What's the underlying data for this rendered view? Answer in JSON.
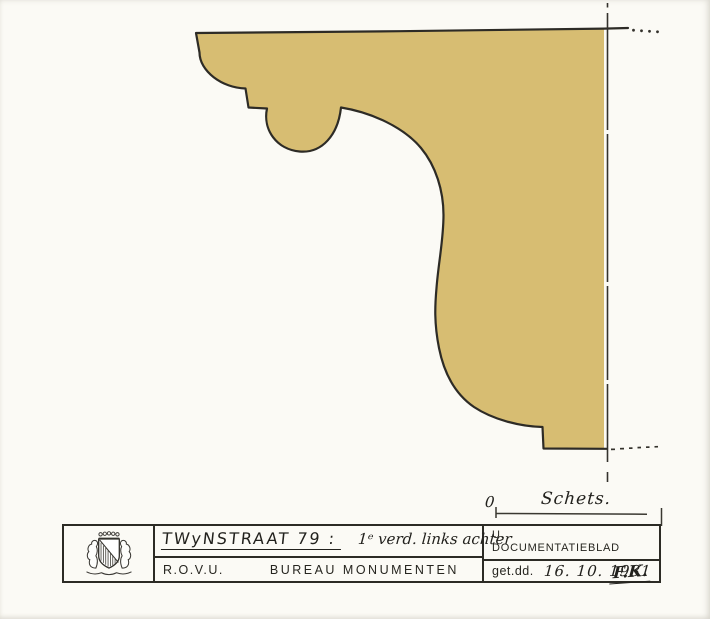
{
  "colors": {
    "shape_fill": "#d7bd72",
    "ink": "#2d2b26",
    "paper": "#fbfaf5"
  },
  "drawing": {
    "scale_zero": "0",
    "scale_label": "Schets."
  },
  "title_block": {
    "street_title": "TWyNSTRAAT 79 :",
    "annotation": "1ᵉ verd. links achter",
    "org_abbr": "R.O.V.U.",
    "org_dept": "BUREAU MONUMENTEN",
    "doc_line1": "U.",
    "doc_line2": "DOCUMENTATIEBLAD",
    "drawn_label": "get.dd.",
    "drawn_date": "16. 10. 1981",
    "signature": "F.K."
  },
  "logo": {
    "name": "utrecht-coat-of-arms"
  }
}
